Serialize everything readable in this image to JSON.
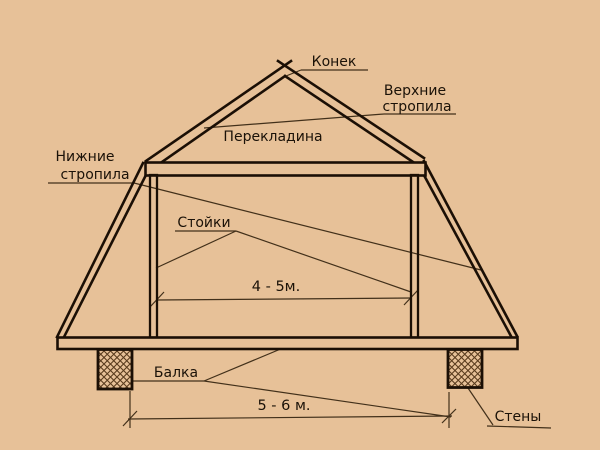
{
  "diagram_title": "Мансардная крыша — схема стропильной системы",
  "colors": {
    "background": "#e7c198",
    "structural_ink": "#1b0f05",
    "thin_line": "#42301a",
    "text": "#1b1208"
  },
  "labels": {
    "ridge": "Конек",
    "upper_rafters_line1": "Верхние",
    "upper_rafters_line2": "стропила",
    "crossbar": "Перекладина",
    "lower_rafters_line1": "Нижние",
    "lower_rafters_line2": "стропила",
    "posts": "Стойки",
    "beam": "Балка",
    "walls": "Стены"
  },
  "dimensions": {
    "attic_width": "4 - 5м.",
    "base_width": "5 - 6 м."
  }
}
